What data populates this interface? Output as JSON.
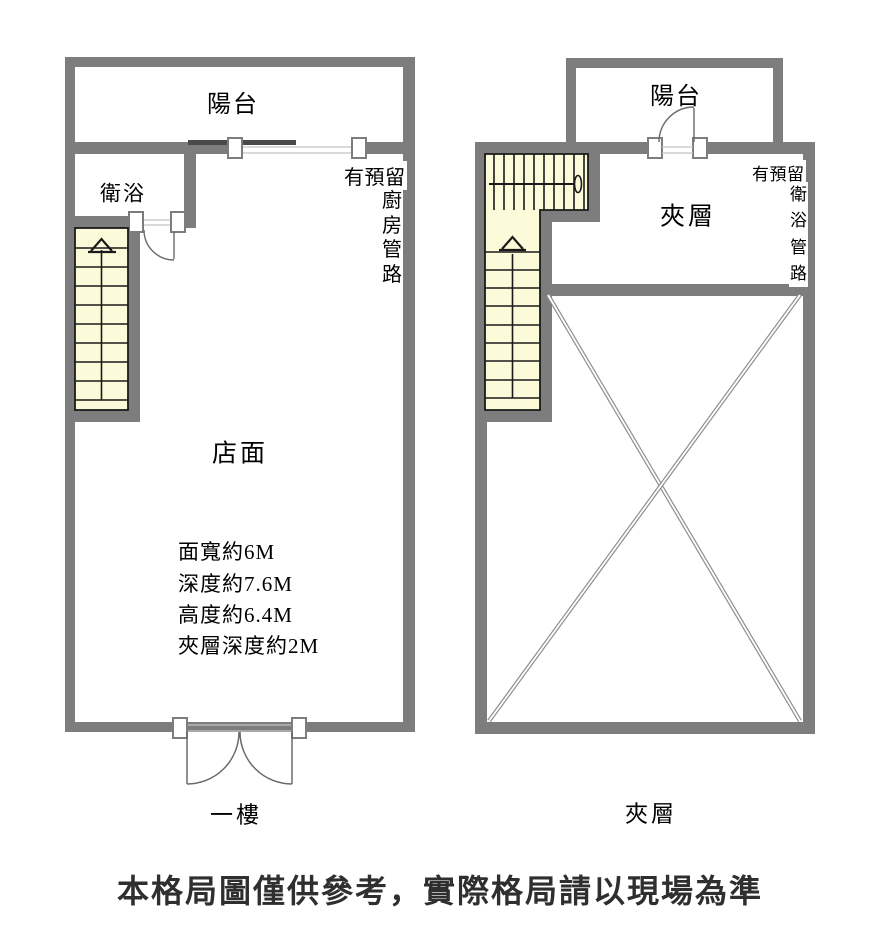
{
  "first_floor": {
    "balcony_label": "陽台",
    "bathroom_label": "衛浴",
    "store_label": "店面",
    "dimensions": [
      "面寬約6M",
      "深度約7.6M",
      "高度約6.4M",
      "夾層深度約2M"
    ],
    "pipe_note_prefix": "有預留",
    "pipe_note_vertical": "廚房管路",
    "floor_label": "一樓"
  },
  "mezzanine": {
    "balcony_label": "陽台",
    "room_label": "夾層",
    "pipe_note_prefix": "有預留",
    "pipe_note_vertical": "衛浴管路",
    "floor_label": "夾層"
  },
  "disclaimer": "本格局圖僅供參考，實際格局請以現場為準",
  "colors": {
    "wall": "#7d7d7d",
    "stair_fill": "#fbfbd9",
    "tread_line": "#1a1a1a",
    "void_cross_line": "#8f8f8f",
    "window_line": "#c4c4c4",
    "lintel_beam": "#4a4a4a",
    "disclaimer_text": "#2f2f2f"
  }
}
